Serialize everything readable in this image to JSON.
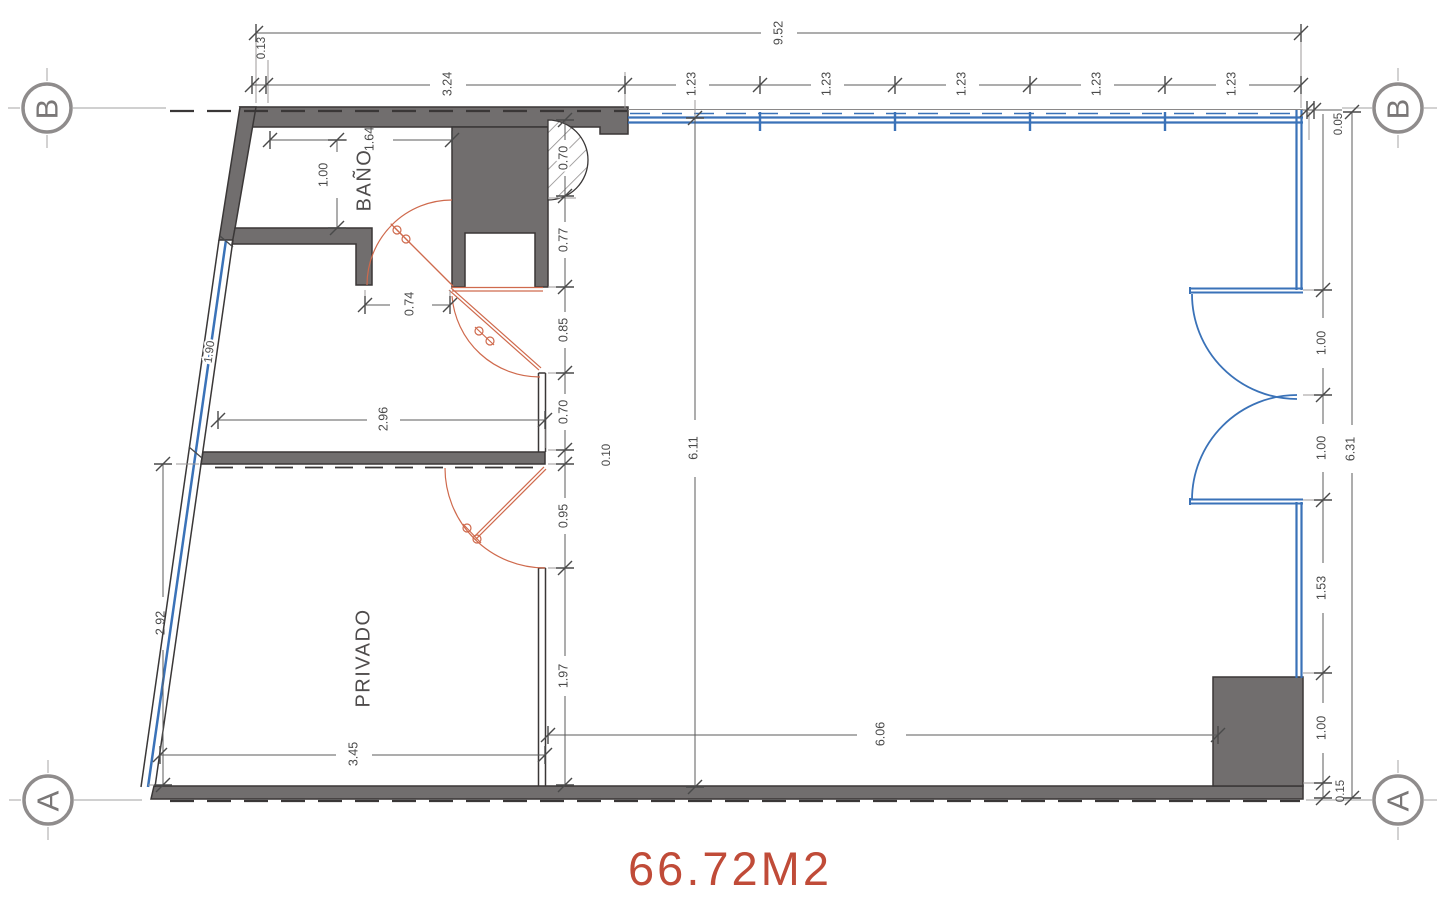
{
  "title": {
    "area_label": "66.72M2"
  },
  "rooms": {
    "bathroom": "BAÑO",
    "private": "PRIVADO"
  },
  "grid": {
    "top_left": "B",
    "top_right": "B",
    "bottom_left": "A",
    "bottom_right": "A"
  },
  "dims": {
    "overall_top": "9.52",
    "top_offset": "0.13",
    "row2": [
      "3.24",
      "1.23",
      "1.23",
      "1.23",
      "1.23",
      "1.23"
    ],
    "right": {
      "gap": "0.05",
      "overall": "6.31",
      "chain": [
        "1.00",
        "1.00",
        "1.53",
        "1.00",
        "0.15"
      ]
    },
    "mid": [
      "0.70",
      "0.77",
      "0.85",
      "0.70",
      "0.10",
      "0.95",
      "1.97"
    ],
    "inner_height": "6.11",
    "main_width": "6.06",
    "bath": {
      "width": "1.64",
      "depth": "1.00",
      "door": "0.74"
    },
    "hall_width": "2.96",
    "left": {
      "window": "1.90",
      "lower": "2.92"
    },
    "private_width": "3.45"
  },
  "colors": {
    "wall": "#716e6e",
    "wall_outline": "#3a3737",
    "glass": "#3a72b8",
    "door": "#cf6a4d",
    "dimension": "#4a4a4a",
    "area_text": "#c04b38"
  }
}
